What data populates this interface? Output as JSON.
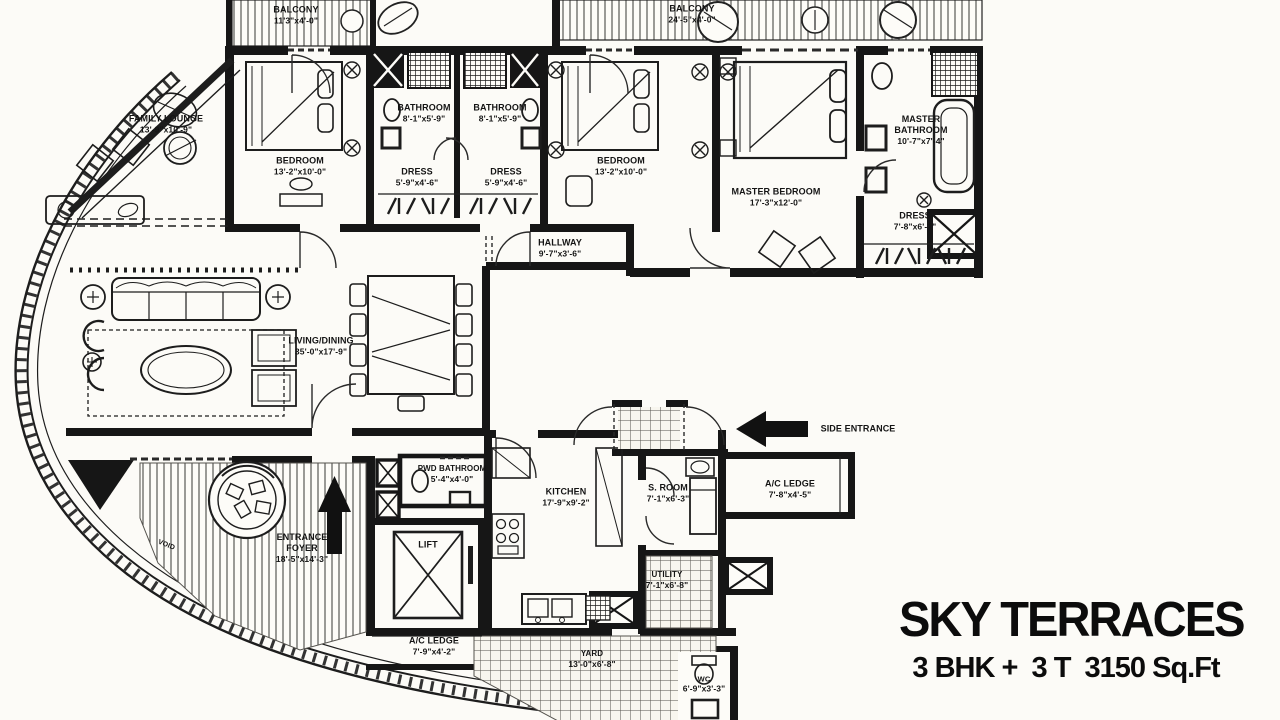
{
  "meta": {
    "kind": "apartment floor plan",
    "colors": {
      "wall": "#161616",
      "paper": "#fcfbf7",
      "ink": "#141414"
    }
  },
  "title_block": {
    "title": "SKY TERRACES",
    "subtitle": "3 BHK +  3 T  3150 Sq.Ft"
  },
  "rooms": [
    {
      "id": "balcony-left",
      "name": "BALCONY",
      "dims": "11'3\"x4'-0\"",
      "x": 296,
      "y": 15
    },
    {
      "id": "balcony-right",
      "name": "BALCONY",
      "dims": "24'-5\"x4'-0\"",
      "x": 692,
      "y": 14
    },
    {
      "id": "family-lounge",
      "name": "FAMILY LOUNGE",
      "dims": "13'-9\"x10'-9\"",
      "x": 166,
      "y": 124,
      "w": 130
    },
    {
      "id": "bedroom-1",
      "name": "BEDROOM",
      "dims": "13'-2\"x10'-0\"",
      "x": 300,
      "y": 166
    },
    {
      "id": "bathroom-1",
      "name": "BATHROOM",
      "dims": "8'-1\"x5'-9\"",
      "x": 424,
      "y": 113
    },
    {
      "id": "bathroom-2",
      "name": "BATHROOM",
      "dims": "8'-1\"x5'-9\"",
      "x": 500,
      "y": 113
    },
    {
      "id": "dress-1",
      "name": "DRESS",
      "dims": "5'-9\"x4'-6\"",
      "x": 417,
      "y": 177
    },
    {
      "id": "dress-2",
      "name": "DRESS",
      "dims": "5'-9\"x4'-6\"",
      "x": 506,
      "y": 177
    },
    {
      "id": "bedroom-2",
      "name": "BEDROOM",
      "dims": "13'-2\"x10'-0\"",
      "x": 621,
      "y": 166
    },
    {
      "id": "master-bedroom",
      "name": "MASTER BEDROOM",
      "dims": "17'-3\"x12'-0\"",
      "x": 776,
      "y": 197,
      "w": 150
    },
    {
      "id": "master-bathroom",
      "name": "MASTER BATHROOM",
      "dims": "10'-7\"x7'-4\"",
      "x": 921,
      "y": 130,
      "w": 76
    },
    {
      "id": "dress-master",
      "name": "DRESS",
      "dims": "7'-8\"x6'-1\"",
      "x": 915,
      "y": 221
    },
    {
      "id": "hallway",
      "name": "HALLWAY",
      "dims": "9'-7\"x3'-6\"",
      "x": 560,
      "y": 248
    },
    {
      "id": "living-dining",
      "name": "LIVING/DINING",
      "dims": "35'-0\"x17'-9\"",
      "x": 321,
      "y": 346,
      "w": 120
    },
    {
      "id": "side-entrance",
      "name": "SIDE ENTRANCE",
      "dims": "",
      "x": 858,
      "y": 429,
      "w": 110
    },
    {
      "id": "pwd-bathroom",
      "name": "PWD BATHROOM",
      "dims": "5'-4\"x4'-0\"",
      "x": 452,
      "y": 474,
      "w": 110,
      "fs": 8
    },
    {
      "id": "kitchen",
      "name": "KITCHEN",
      "dims": "17'-9\"x9'-2\"",
      "x": 566,
      "y": 497
    },
    {
      "id": "s-room",
      "name": "S. ROOM",
      "dims": "7'-1\"x6'-3\"",
      "x": 668,
      "y": 493
    },
    {
      "id": "ac-ledge-right",
      "name": "A/C LEDGE",
      "dims": "7'-8\"x4'-5\"",
      "x": 790,
      "y": 489
    },
    {
      "id": "entrance-foyer",
      "name": "ENTRANCE FOYER",
      "dims": "18'-5\"x14'-3\"",
      "x": 302,
      "y": 548,
      "w": 84
    },
    {
      "id": "lift",
      "name": "LIFT",
      "dims": "",
      "x": 428,
      "y": 545
    },
    {
      "id": "ac-ledge-bottom",
      "name": "A/C LEDGE",
      "dims": "7'-9\"x4'-2\"",
      "x": 434,
      "y": 646
    },
    {
      "id": "utility",
      "name": "UTILITY",
      "dims": "7'-1\"x6'-8\"",
      "x": 667,
      "y": 580,
      "fs": 8
    },
    {
      "id": "yard",
      "name": "YARD",
      "dims": "13'-0\"x6'-8\"",
      "x": 592,
      "y": 659,
      "fs": 8
    },
    {
      "id": "wc",
      "name": "WC",
      "dims": "6'-9\"x3'-3\"",
      "x": 704,
      "y": 684,
      "fs": 7.5
    },
    {
      "id": "void",
      "name": "VOID",
      "dims": "",
      "x": 166,
      "y": 546,
      "rotate": 22,
      "fs": 7
    }
  ]
}
